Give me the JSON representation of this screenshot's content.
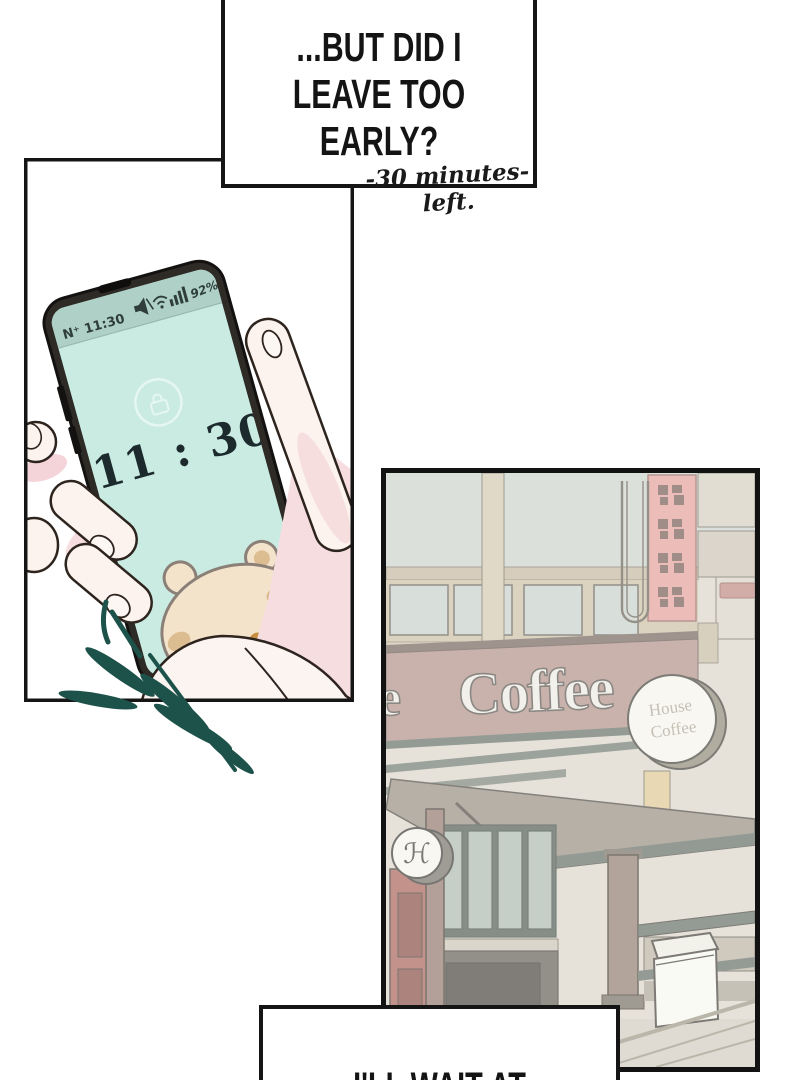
{
  "speech_top": {
    "line1": "...BUT DID I",
    "line2": "LEAVE TOO EARLY?"
  },
  "caption_note": {
    "text": "-30 minutes- left."
  },
  "phone": {
    "status_left": "N⁺ 11:30",
    "battery": "92%",
    "clock": "11 : 30"
  },
  "coffee_shop": {
    "marquee_partial": "e",
    "marquee": "Coffee",
    "round_sign_top": "House",
    "round_sign_bottom": "Coffee",
    "door_monogram": "ℋ"
  },
  "speech_bottom": {
    "line1": "I'LL WAIT AT"
  },
  "colors": {
    "screen_mint": "#c9ebe2",
    "status_strip": "#aed0c7",
    "leaf_teal": "#1d524a",
    "red_sign": "#e29a93",
    "marquee_band": "#ad8b82",
    "awning": "#908878",
    "clock_text": "#1c2a2e"
  }
}
